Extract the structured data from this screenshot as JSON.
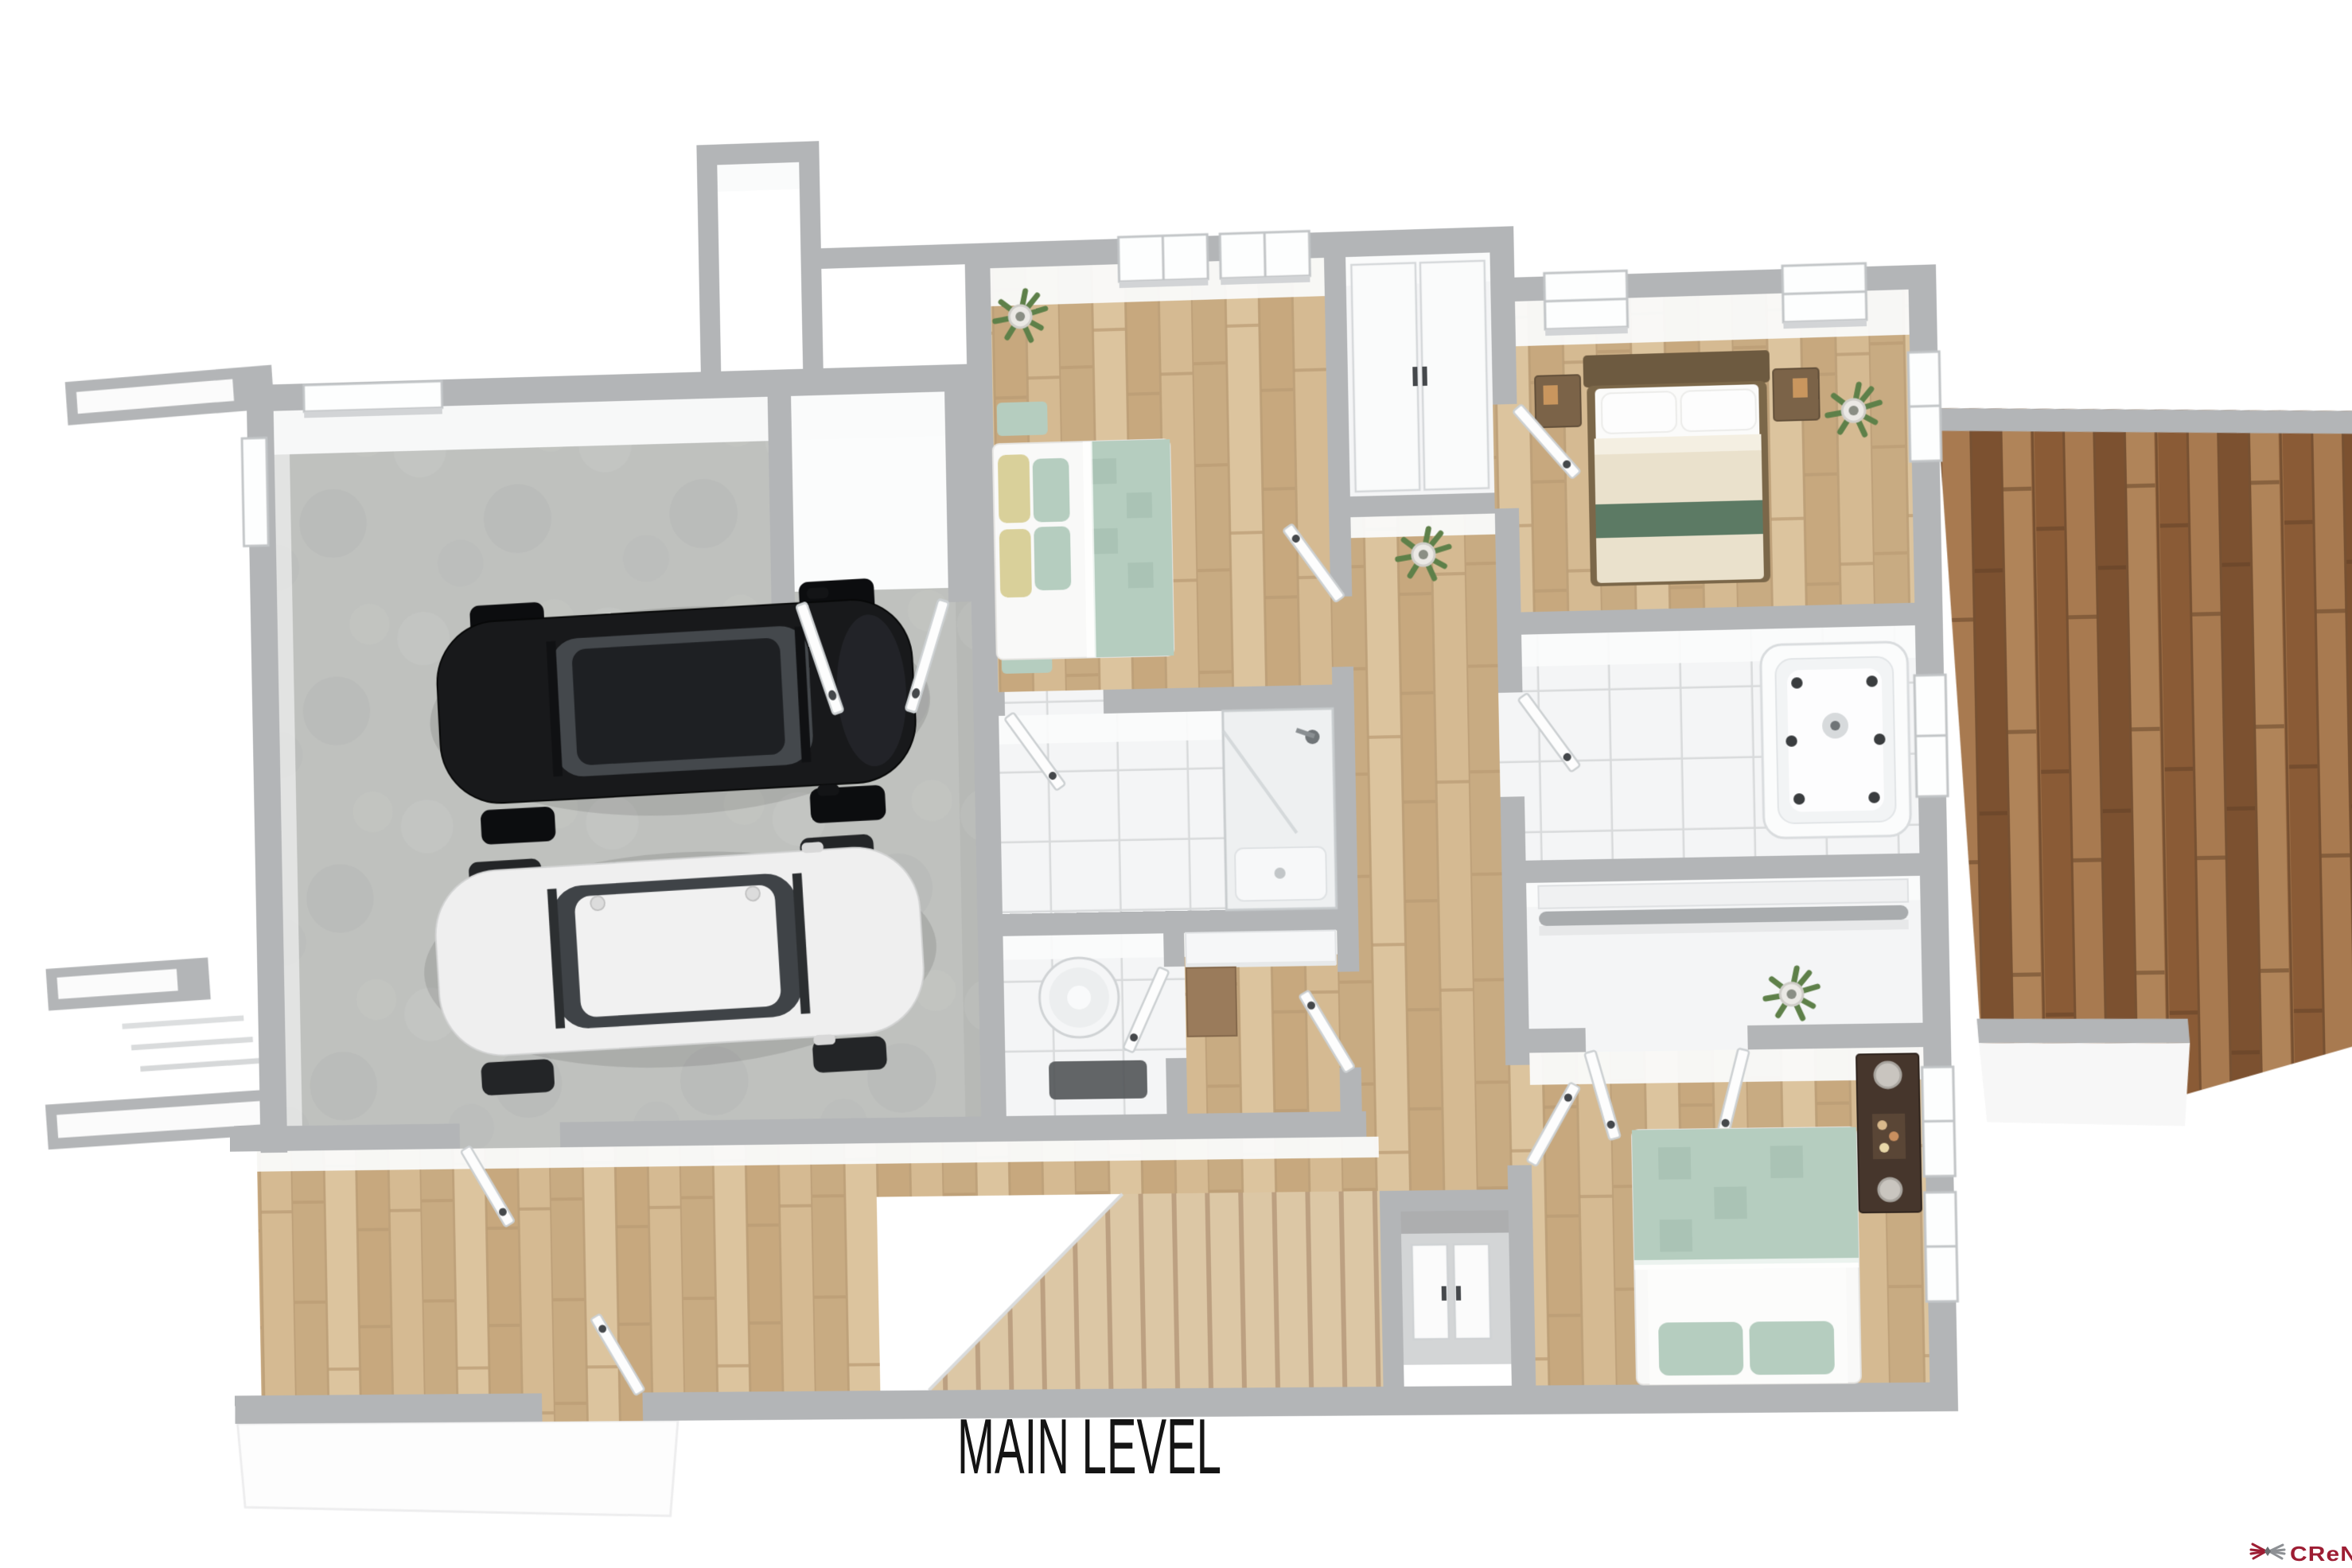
{
  "title": "MAIN LEVEL",
  "logo": {
    "text": "CReN"
  },
  "colors": {
    "wall": "#b3b5b7",
    "roomWhite": "#f4f5f6",
    "concrete": "#bfc1be",
    "woodBase": "#d0b58f",
    "deckBase": "#9a6c44",
    "tile": "#f4f5f6",
    "grout": "#d8dadb",
    "sage": "#b5cdbf",
    "yellow": "#d9d09a",
    "cream": "#eae1cc",
    "greenBand": "#5c7a64",
    "headboard": "#6d5a40",
    "dresser": "#46362c",
    "carBlack": "#18191b",
    "carWhite": "#efefef",
    "plant": "#5e8049",
    "title": "#141414",
    "logoRed": "#9d1d33",
    "logoGray": "#8d9094"
  },
  "floor_plan": {
    "view": "3D overhead dollhouse rendering of a single-family home main level",
    "rooms": [
      {
        "name": "Garage",
        "floor": "concrete",
        "contents": [
          "black car",
          "white car",
          "double-door storage closet",
          "windows"
        ]
      },
      {
        "name": "Bedroom 1",
        "floor": "light wood",
        "contents": [
          "bed with sage green blanket and yellow pillows",
          "two sage benches",
          "potted plant",
          "two windows",
          "sliding-door closet"
        ]
      },
      {
        "name": "Hall Bathroom",
        "floor": "white tile",
        "contents": [
          "walk-in shower",
          "door"
        ]
      },
      {
        "name": "Laundry / Utility",
        "floor": "white tile",
        "contents": [
          "water-heater cylinder",
          "dark floor mat"
        ]
      },
      {
        "name": "Mudroom",
        "floor": "light wood",
        "contents": [
          "counter with wood cabinet"
        ]
      },
      {
        "name": "Hallway",
        "floor": "light wood",
        "contents": [
          "potted plant"
        ]
      },
      {
        "name": "Master Bedroom",
        "floor": "light wood",
        "contents": [
          "bed with cream duvet and green runner",
          "dark wood headboard",
          "two nightstands",
          "potted plant",
          "two skylight windows"
        ]
      },
      {
        "name": "Master Bathroom",
        "floor": "white tile",
        "contents": [
          "jetted tub",
          "window"
        ]
      },
      {
        "name": "Walk-in Closet",
        "floor": "white",
        "contents": [
          "long shelf with hanging rod",
          "double doors"
        ]
      },
      {
        "name": "Bedroom 3",
        "floor": "light wood",
        "contents": [
          "bed with sage green bedding",
          "dark wood dresser with vases",
          "two windows"
        ]
      },
      {
        "name": "Entry / Foyer",
        "floor": "light wood",
        "contents": [
          "staircase down",
          "stairwell showing lower-level doors",
          "front door",
          "door to garage"
        ]
      },
      {
        "name": "Deck",
        "floor": "dark stained wood planks",
        "contents": [
          "railing wall"
        ]
      }
    ]
  }
}
